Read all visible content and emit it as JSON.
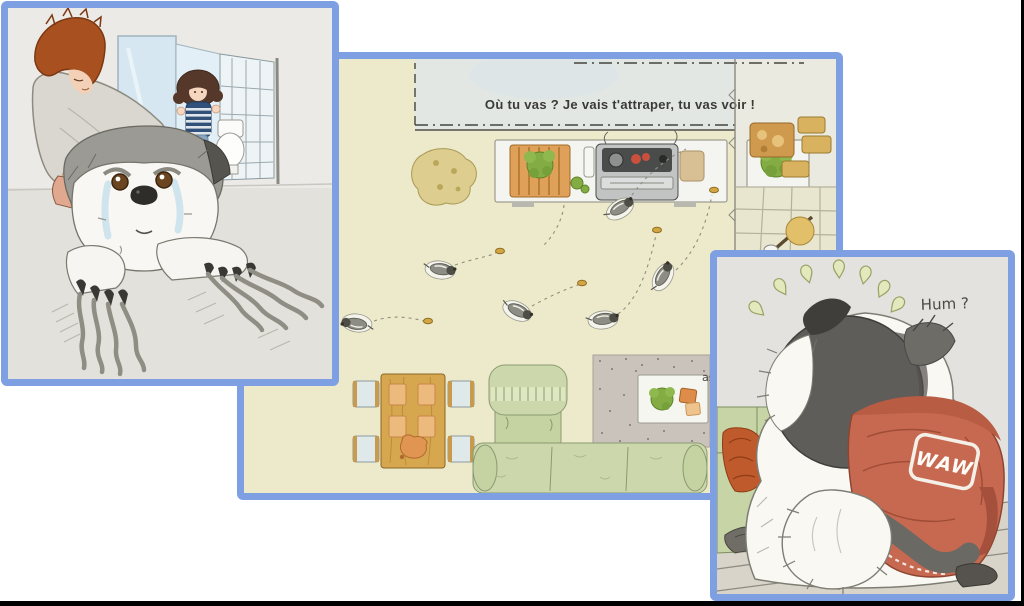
{
  "panels": {
    "middle": {
      "speech": "Où tu vas ? Je vais t'attraper, tu vas voir !",
      "cutoff": "as !"
    },
    "right": {
      "exclaim": "Hum ?",
      "hoodie_text": "WAW"
    }
  },
  "colors": {
    "panel_border": "#7e9fe2",
    "page_background": "#ffffff",
    "scan_edge": "#000000",
    "floor_cream": "#edeacb",
    "hoodie_red": "#c76950",
    "couch_green": "#ccd8ac"
  }
}
